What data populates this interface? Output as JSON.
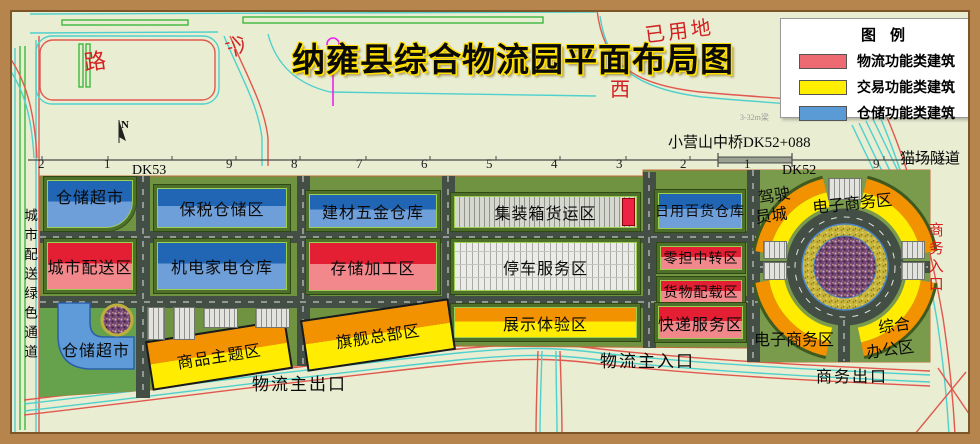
{
  "title": "纳雍县综合物流园平面布局图",
  "legend": {
    "title": "图例",
    "items": [
      {
        "label": "物流功能类建筑",
        "color": "#ee6a72"
      },
      {
        "label": "交易功能类建筑",
        "color": "#ffee00"
      },
      {
        "label": "仓储功能类建筑",
        "color": "#5b9bd5"
      }
    ]
  },
  "compass": {
    "north": "N"
  },
  "railway": {
    "dk53": "DK53",
    "dk52": "DK52",
    "bridge": "小营山中桥DK52+088",
    "tunnel": "猫场隧道",
    "beam_note": "3-32m梁",
    "ticks": [
      "2",
      "1",
      "9",
      "8",
      "7",
      "6",
      "5",
      "4",
      "3",
      "2",
      "1",
      "9"
    ]
  },
  "map_labels": {
    "road": "路",
    "sand": "沙",
    "used_land": "已用地",
    "west": "西",
    "green_channel": "城市配送绿色通道",
    "logistics_exit": "物流主出口",
    "logistics_entrance": "物流主入口",
    "business_exit": "商务出口",
    "business_entrance": "商务入口"
  },
  "zones": {
    "storage_supermarket_1": "仓储超市",
    "bonded_storage": "保税仓储区",
    "building_materials_warehouse": "建材五金仓库",
    "container_freight": "集装箱货运区",
    "daily_goods_warehouse": "日用百货仓库",
    "city_distribution": "城市配送区",
    "electromechanical_warehouse": "机电家电仓库",
    "storage_processing": "存储加工区",
    "parking_service": "停车服务区",
    "ltl_transfer": "零担中转区",
    "cargo_loading": "货物配载区",
    "storage_supermarket_2": "仓储超市",
    "commodity_theme": "商品主题区",
    "flagship_hq": "旗舰总部区",
    "exhibition_experience": "展示体验区",
    "express_service": "快递服务区"
  },
  "roundabout": {
    "driver_city_line1": "驾驶",
    "driver_city_line2": "员城",
    "ecommerce_ne": "电子商务区",
    "ecommerce_sw": "电子商务区",
    "office_line1": "综合",
    "office_line2": "办公区"
  },
  "colors": {
    "background": "#e9edd2",
    "frame_brown": "#b5854d",
    "park_green": "#6f9340",
    "road_gray": "#434e44",
    "logistics_red": "#e41f33",
    "trade_yellow": "#ffec00",
    "trade_orange": "#f29200",
    "storage_blue": "#2166b5",
    "outside_road_red": "#e0584f",
    "outside_road_cyan": "#4fd0cd"
  }
}
